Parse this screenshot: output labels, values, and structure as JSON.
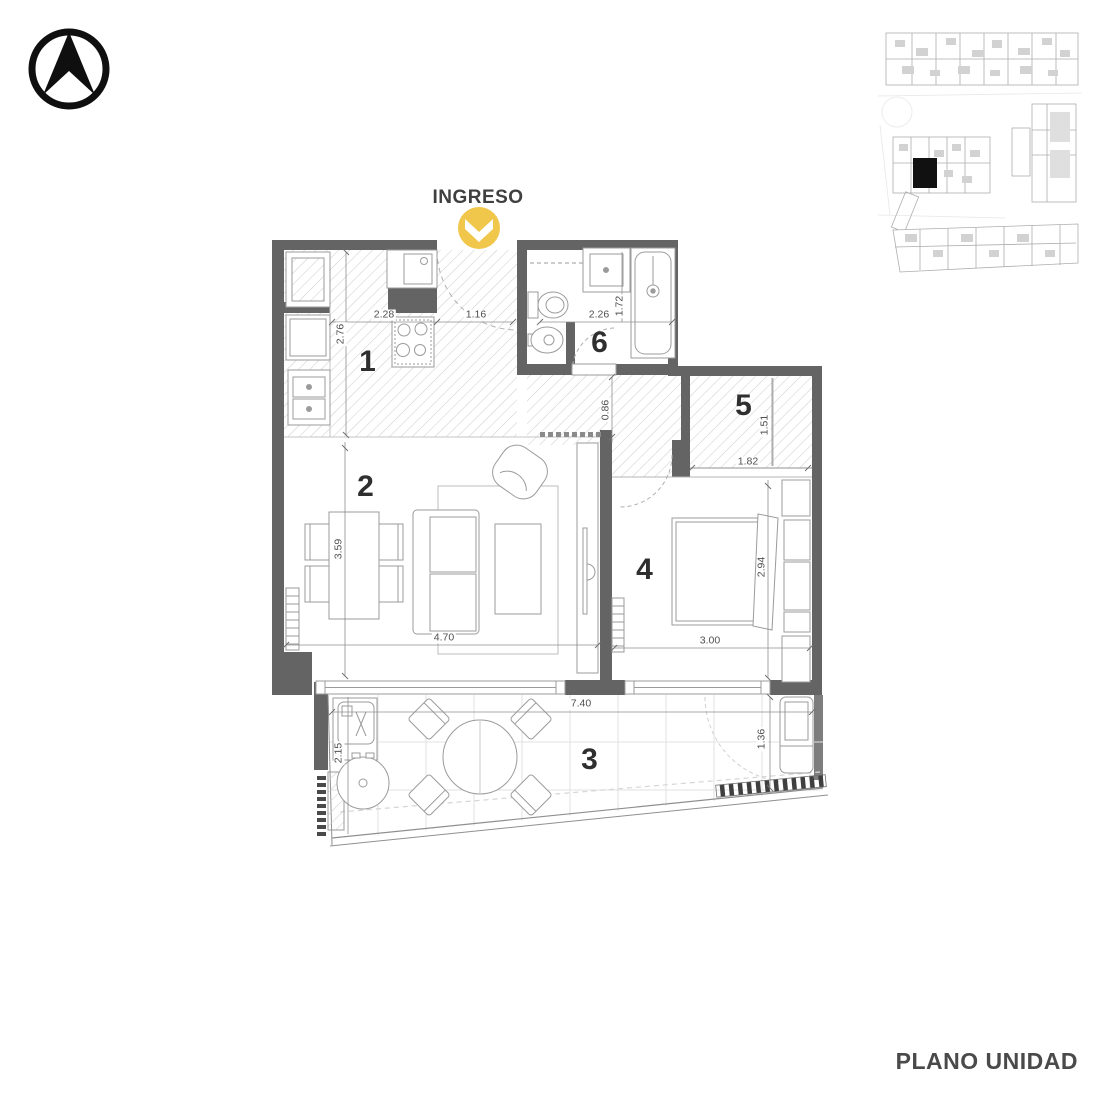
{
  "plan": {
    "entry_label": "INGRESO",
    "title": "PLANO UNIDAD",
    "rooms": [
      {
        "number": "1",
        "dims": [
          "2.28",
          "2.76",
          "1.16"
        ]
      },
      {
        "number": "2",
        "dims": [
          "3.59",
          "4.70"
        ]
      },
      {
        "number": "3",
        "dims": [
          "7.40",
          "2.15",
          "1.36"
        ]
      },
      {
        "number": "4",
        "dims": [
          "3.00",
          "2.94"
        ]
      },
      {
        "number": "5",
        "dims": [
          "1.82",
          "1.51"
        ]
      },
      {
        "number": "6",
        "dims": [
          "2.26",
          "1.72",
          "0.86"
        ]
      }
    ]
  },
  "icons": {
    "north_compass": "north-arrow-compass",
    "entry_marker": "chevron-down-badge",
    "unit_location": "filled-unit-marker"
  },
  "colors": {
    "accent_yellow": "#F0C74B",
    "wall_gray": "#646464",
    "line_gray": "#9b9b9b",
    "hatch_gray": "#cfcfcf",
    "text_dark": "#3f3f3f",
    "dim_text": "#4f4f4f",
    "unit_marker_black": "#111111"
  }
}
